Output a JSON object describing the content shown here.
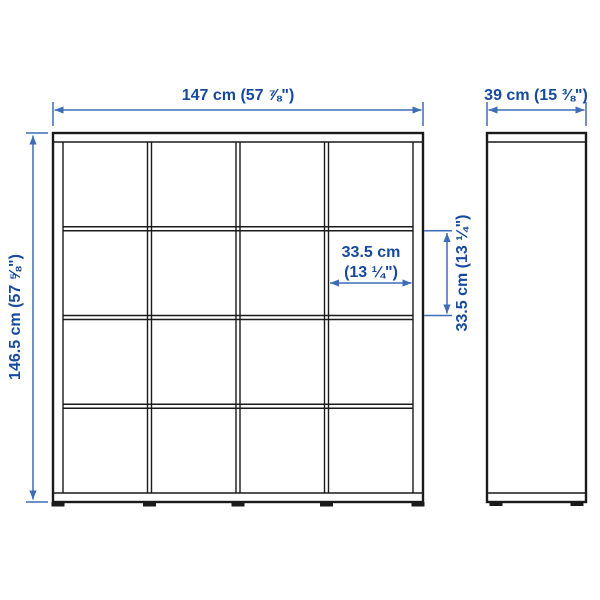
{
  "diagram": {
    "type": "furniture-dimension-drawing",
    "grid": {
      "rows": 4,
      "columns": 4
    }
  },
  "colors": {
    "text_blue": "#17499c",
    "line_blue": "#3e6cb7",
    "ink": "#1a1a1a",
    "background": "#ffffff"
  },
  "dimensions": {
    "width": {
      "label": "147 cm (57 ⅞\")"
    },
    "depth": {
      "label": "39 cm (15 ⅜\")"
    },
    "height": {
      "label": "146.5 cm (57 ⅝\")"
    },
    "cell_width": {
      "line1": "33.5 cm",
      "line2": "(13 ¼\")"
    },
    "cell_height": {
      "label": "33.5 cm (13 ¼\")"
    }
  }
}
